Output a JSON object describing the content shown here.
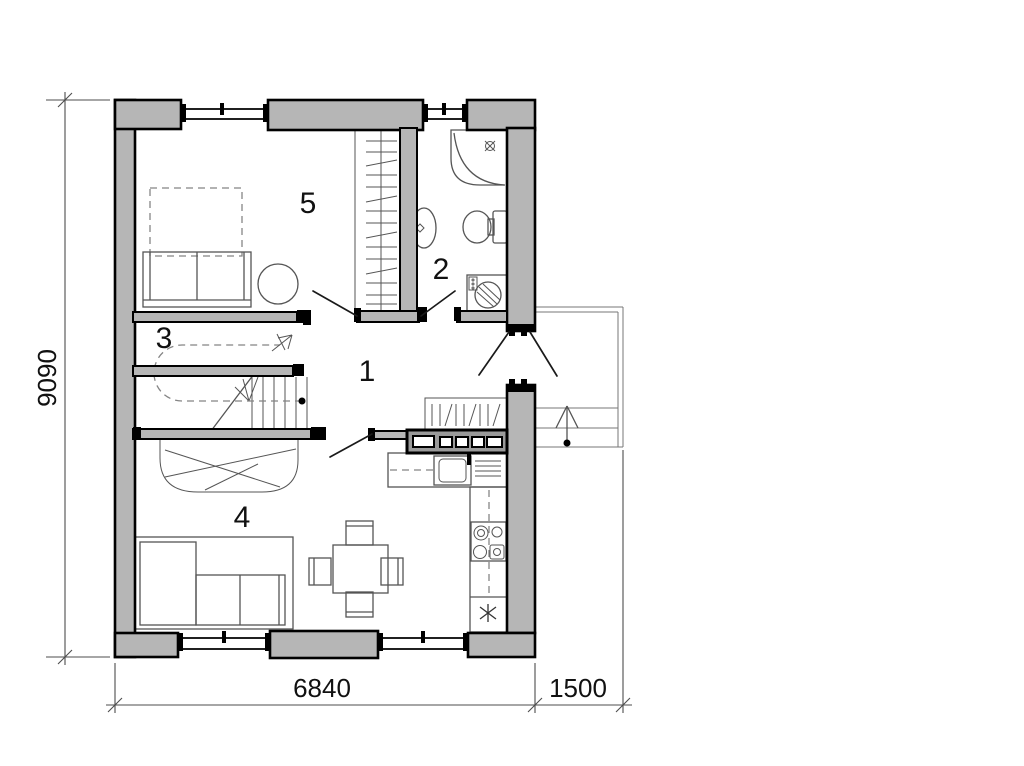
{
  "page": {
    "background": "#ffffff"
  },
  "plan": {
    "type": "floor-plan",
    "room_labels": [
      {
        "number": "1"
      },
      {
        "number": "2"
      },
      {
        "number": "3"
      },
      {
        "number": "4"
      },
      {
        "number": "5"
      }
    ],
    "dimensions": {
      "height_mm": "9090",
      "width_mm": "6840",
      "porch_mm": "1500"
    },
    "colors": {
      "wall_fill": "#b6b6b6",
      "partition_fill": "#9a9a9a",
      "outline": "#000000",
      "furniture_line": "#555555",
      "dimension_line": "#4d4d4d"
    },
    "symbols": [
      "window",
      "door-swing",
      "shower",
      "washbasin",
      "toilet",
      "washing-machine",
      "wardrobe",
      "bed",
      "staircase",
      "walk-line-arrow",
      "kitchen-sink",
      "stove",
      "fridge-snowflake",
      "dining-table",
      "sofa",
      "porch-steps",
      "entry-arrow"
    ]
  }
}
